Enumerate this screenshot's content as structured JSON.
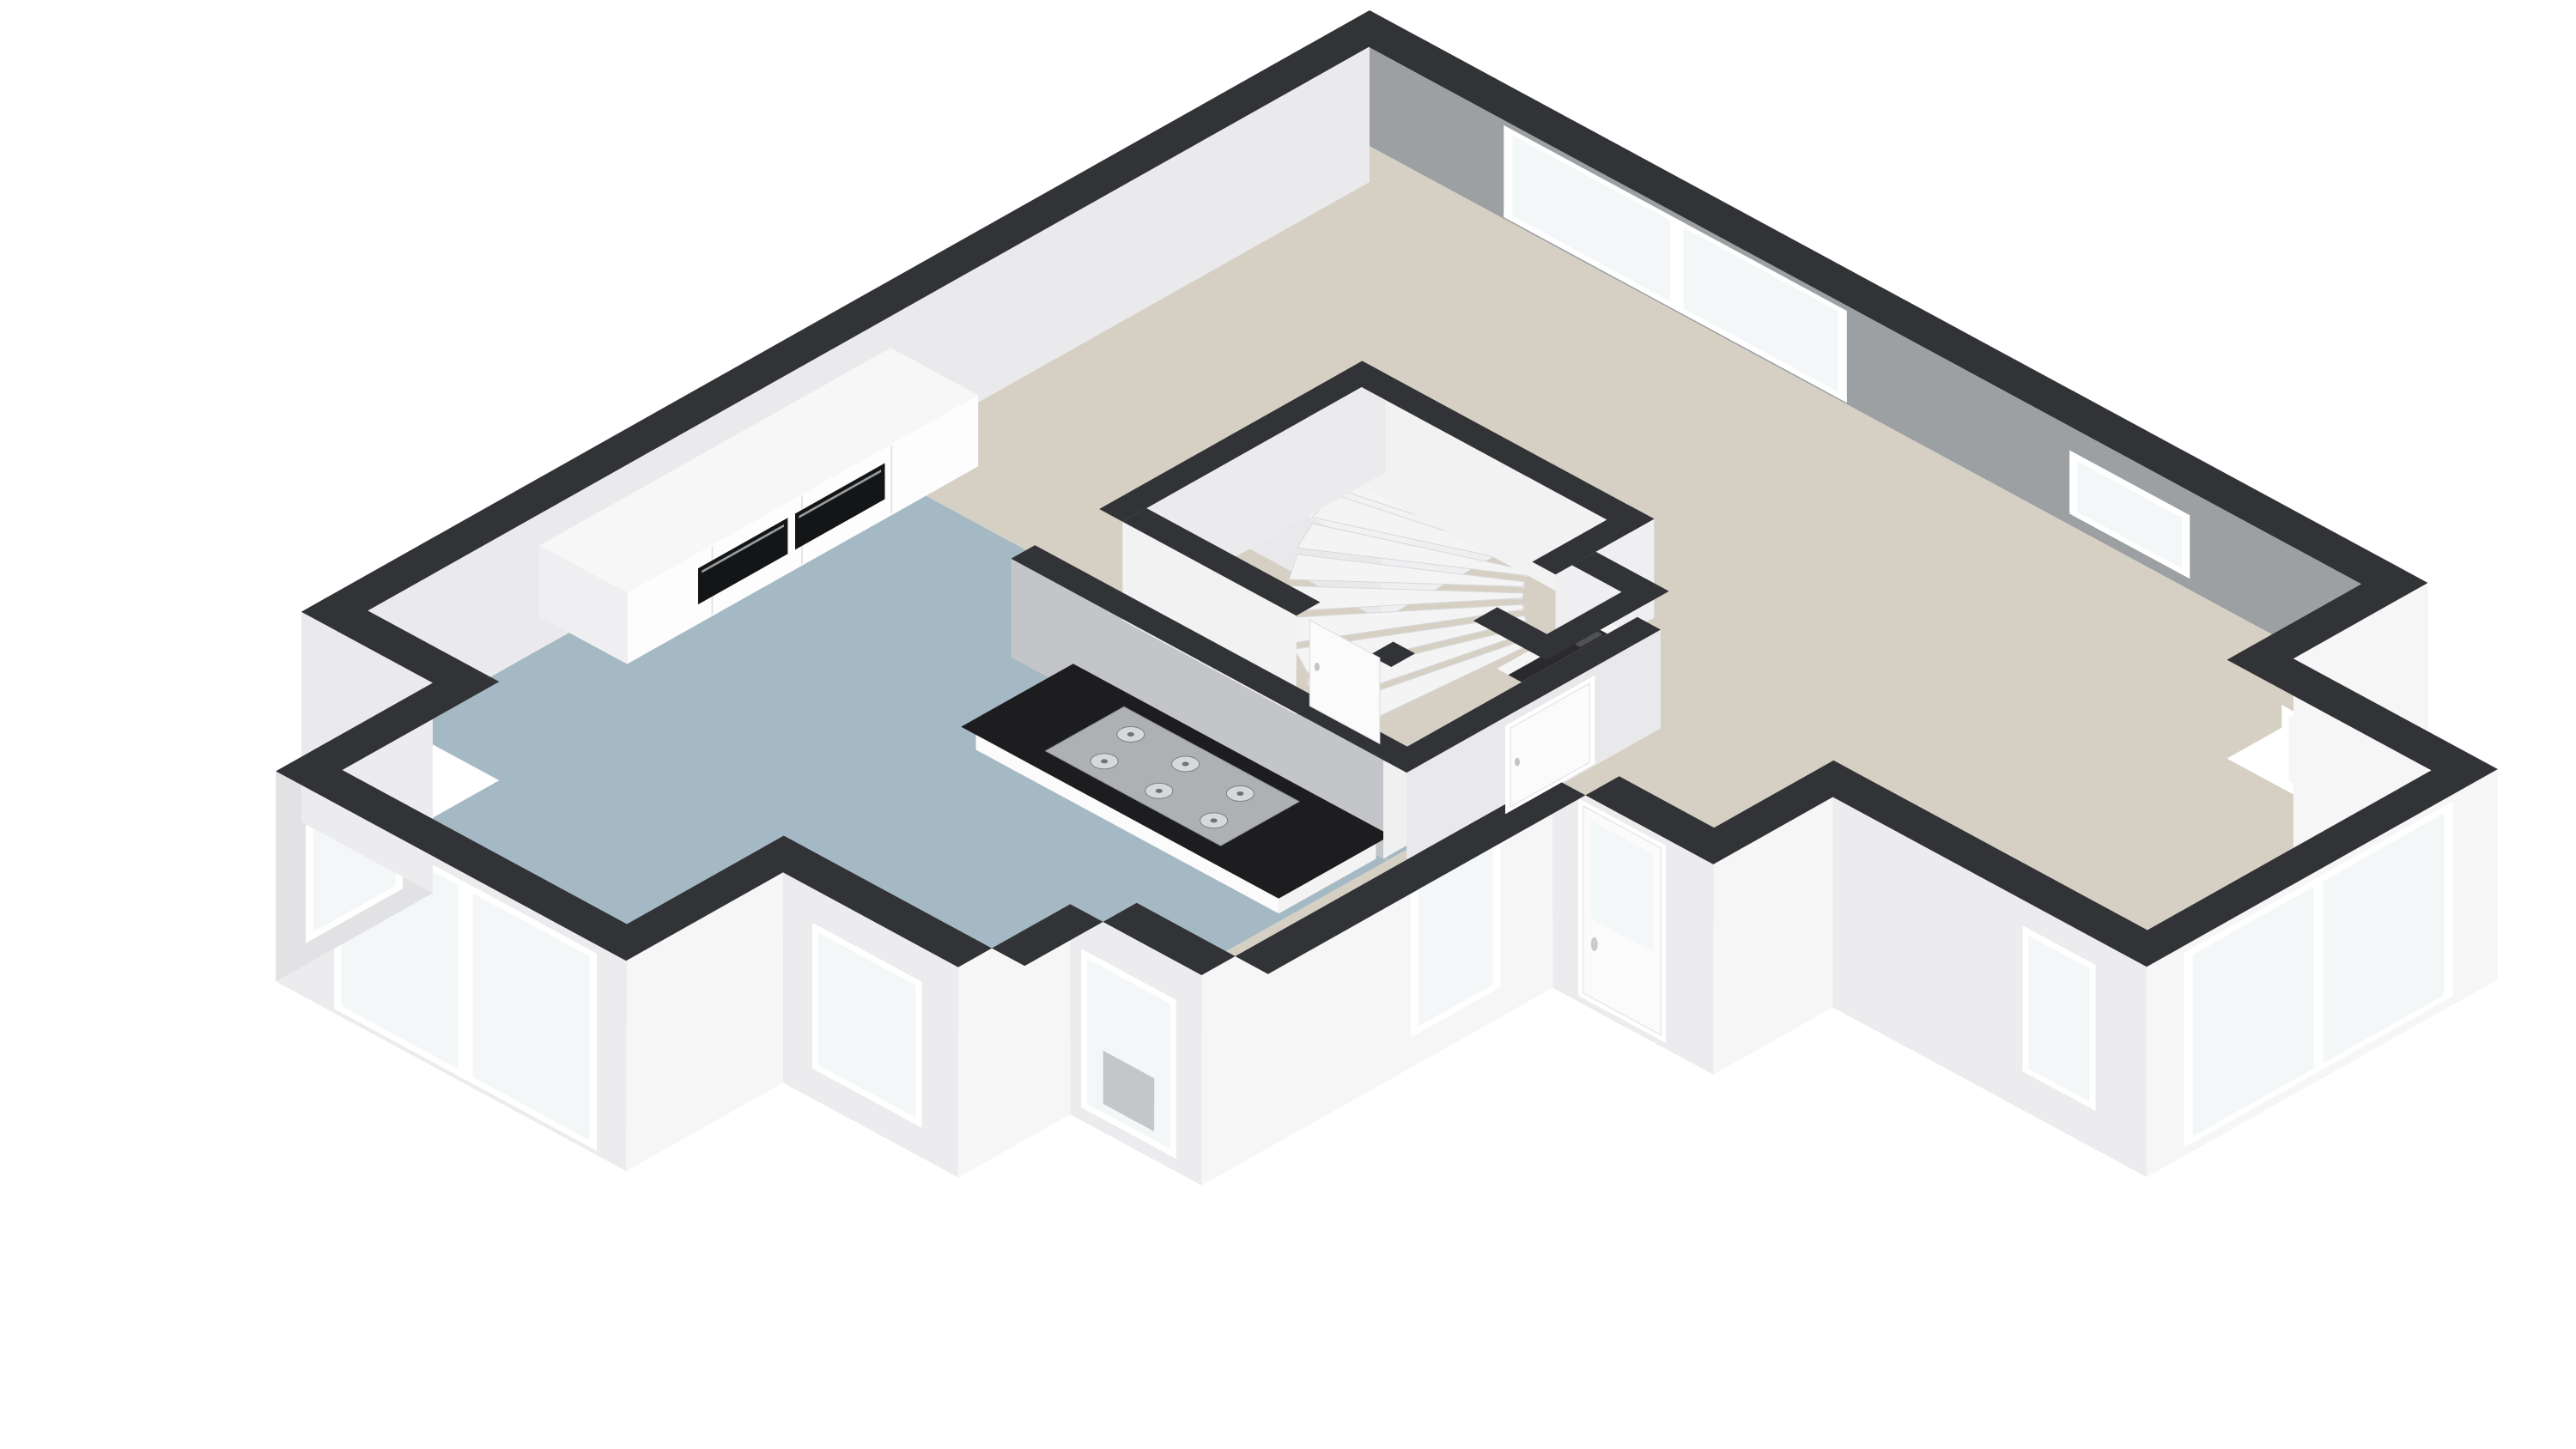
{
  "scene": {
    "title": "3D dollhouse floor plan — ground floor cutaway, isometric view",
    "view": "isometric-top-cutaway",
    "background": "#ffffff",
    "palette": {
      "wall_cap": "#323336",
      "wall_inner_gray": "#9da0a3",
      "wall_inner_white": "#f1f1f3",
      "wall_inner_mid": "#c4c5c8",
      "wall_exterior_light": "#f6f6f7",
      "wall_exterior_shade": "#ececee",
      "wall_exterior_dark": "#e2e2e4",
      "floor_living": "#d6d0c4",
      "floor_kitchen": "#a5b9c4",
      "glass": "#f4f7f8",
      "frame": "#ffffff",
      "counter_top": "#1d1d1f",
      "cooktop_steel": "#aeb1b4",
      "burner": "#d6d8da",
      "burner_ring": "#7d8083",
      "oven_black": "#141517",
      "stair": "#f4f4f5",
      "stair_edge": "#d9d9db",
      "riser": "#e2e2e4",
      "landing": "#f2f2f3",
      "boiler_void": "#2a2a2c",
      "boiler_accent": "#b14a2a",
      "cabinet_front": "#fdfdfe",
      "cabinet_top": "#f7f7f8",
      "door_leaf": "#fbfbfc"
    },
    "rooms": [
      {
        "id": "living-room",
        "floor_color": "#d6d0c4"
      },
      {
        "id": "hallway",
        "floor_color": "#d6d0c4"
      },
      {
        "id": "kitchen",
        "floor_color": "#a5b9c4"
      },
      {
        "id": "stairwell",
        "floor_color": "#d6d0c4"
      },
      {
        "id": "utility-niche",
        "floor_color": "#2a2a2c"
      },
      {
        "id": "entrance-porch",
        "floor_color": "#ffffff"
      },
      {
        "id": "bay-window-living",
        "floor_color": "#d6d0c4"
      },
      {
        "id": "bay-window-kitchen",
        "floor_color": "#a5b9c4"
      }
    ],
    "fixtures": [
      {
        "id": "sliding-glass-door",
        "wall": "north-east",
        "panels": 2
      },
      {
        "id": "small-window-northeast",
        "wall": "north-east"
      },
      {
        "id": "bay-window-right-glazing",
        "panes": 2
      },
      {
        "id": "front-door-with-glass",
        "wall": "south-east"
      },
      {
        "id": "porch-sidelight-window"
      },
      {
        "id": "radiator-window",
        "detail": "radiator visible behind glass"
      },
      {
        "id": "kitchen-bay-tall-windows",
        "panes": 2
      },
      {
        "id": "winder-staircase",
        "steps": 10,
        "shape": "quarter-turn fan"
      },
      {
        "id": "stair-door",
        "leaf": "white"
      },
      {
        "id": "hall-door",
        "leaf": "white"
      },
      {
        "id": "kitchen-tall-cabinets",
        "ovens": 2
      },
      {
        "id": "kitchen-counter",
        "top": "black"
      },
      {
        "id": "gas-cooktop",
        "burners": 6
      },
      {
        "id": "boiler-unit",
        "accent": "#b14a2a"
      }
    ],
    "counts": {
      "stair_steps": 10,
      "hob_burners": 6,
      "built_in_ovens": 2
    }
  }
}
